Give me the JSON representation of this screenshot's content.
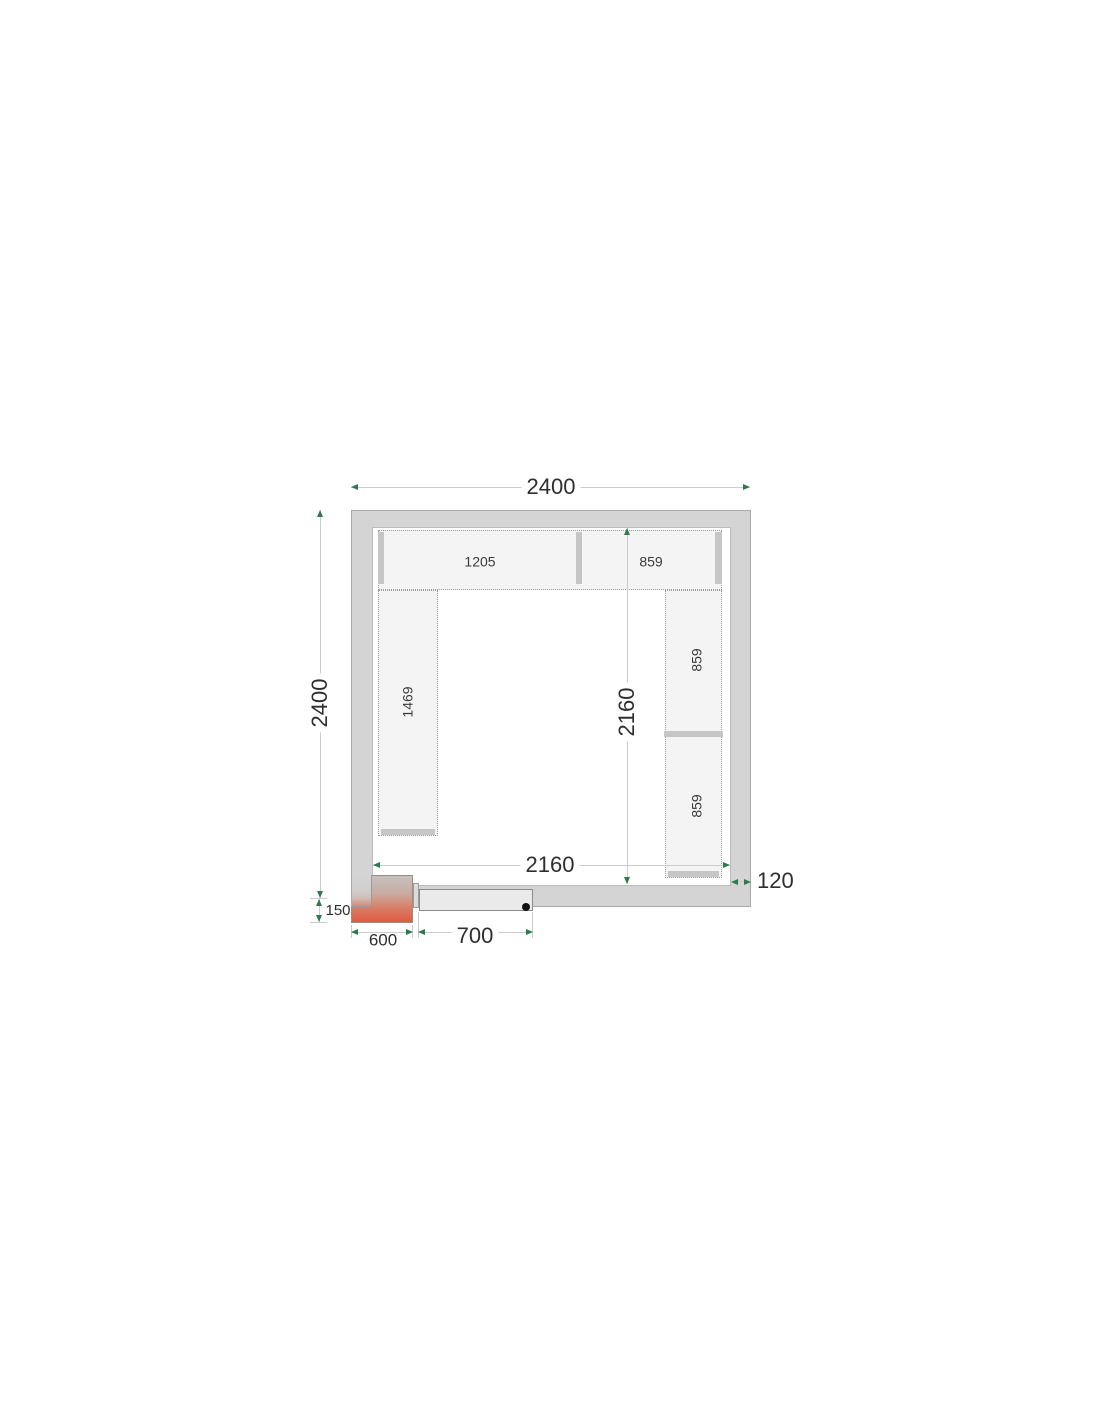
{
  "diagram": {
    "kind": "cold-room panel floor plan",
    "outer_width_mm": "2400",
    "outer_depth_mm": "2400",
    "inner_width_mm": "2160",
    "inner_depth_mm": "2160",
    "wall_thickness_mm": "120",
    "door_width_mm": "700",
    "unit_width_mm": "600",
    "unit_overhang_mm": "150",
    "shelves": {
      "top_left_mm": "1205",
      "top_right_mm": "859",
      "left_mm": "1469",
      "right_upper_mm": "859",
      "right_lower_mm": "859"
    }
  },
  "colors": {
    "wall_fill": "#d4d4d4",
    "shelf_fill": "#f4f4f4",
    "support_bar": "#c6c6c6",
    "dimension_line": "#cbcbcb",
    "arrow_green": "#2e7a4c",
    "unit_gradient_top": "#c4c1bf",
    "unit_gradient_bottom": "#df5a44",
    "door_fill": "#eaeaea",
    "text": "#2e2e2e"
  }
}
